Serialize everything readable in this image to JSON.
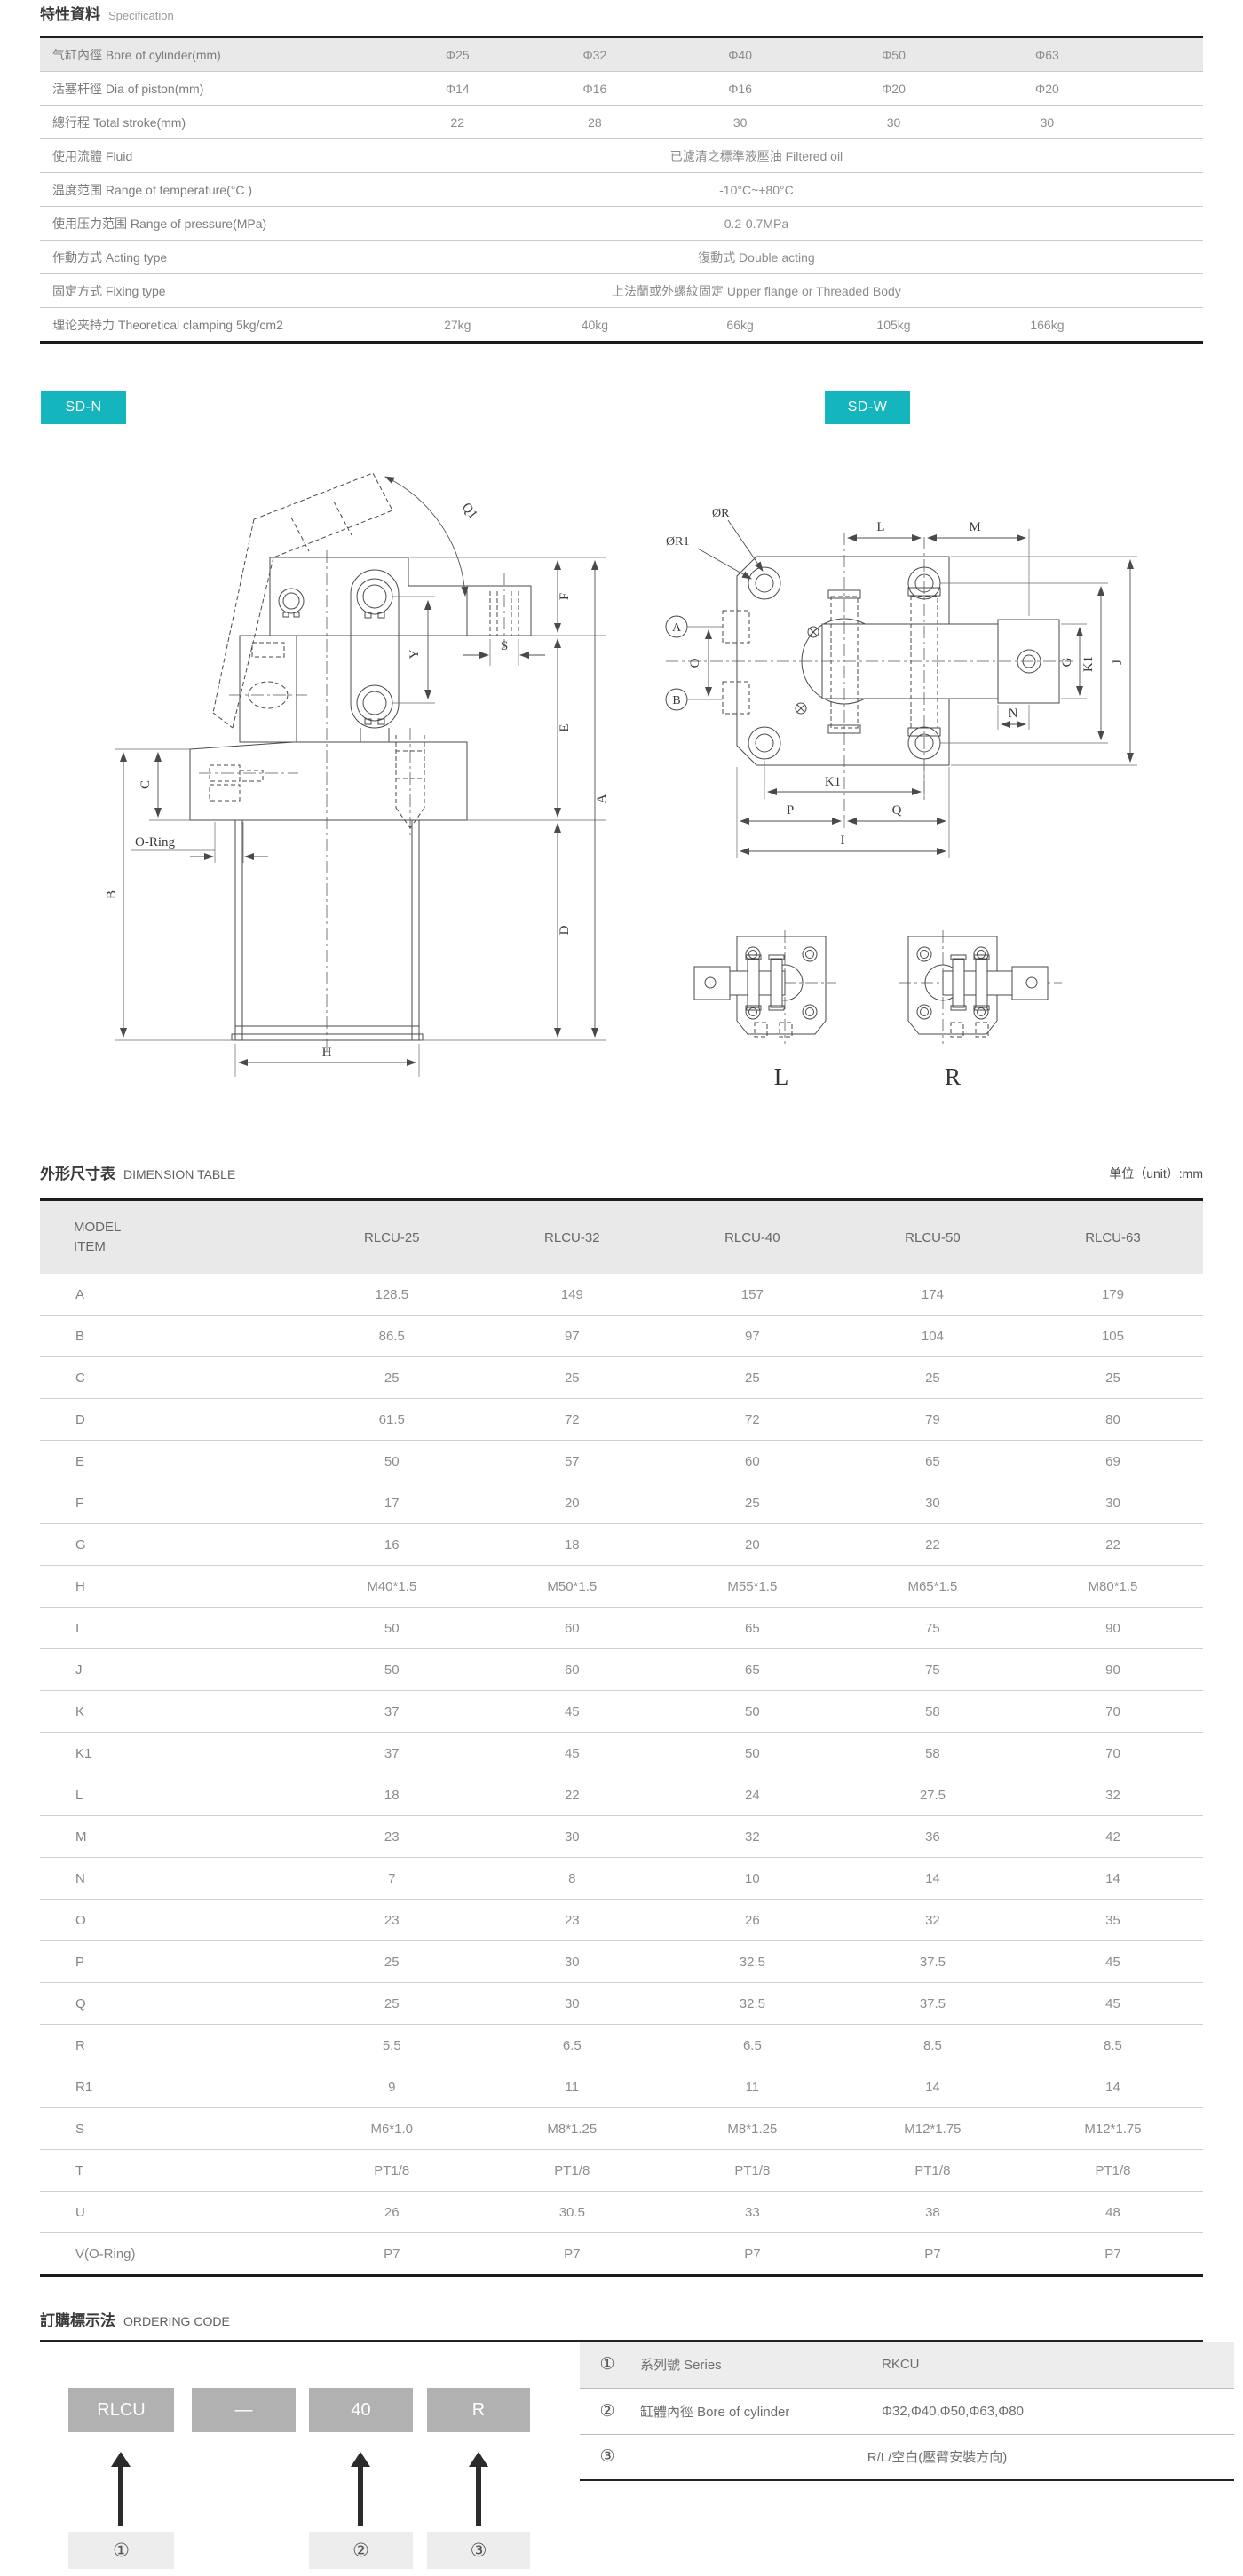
{
  "colors": {
    "accent_teal": "#14b5bc",
    "border_dark": "#1c1c1c",
    "header_bg": "#e9e9e9",
    "code_box_bg": "#b1b1b1",
    "callout_bg": "#ededed"
  },
  "spec_section": {
    "title_zh": "特性資料",
    "title_en": "Specification",
    "rows": [
      {
        "label": "气缸內徑  Bore of cylinder(mm)",
        "cells": [
          "Φ25",
          "Φ32",
          "Φ40",
          "Φ50",
          "Φ63"
        ],
        "shaded": true
      },
      {
        "label": "活塞杆徑  Dia of piston(mm)",
        "cells": [
          "Φ14",
          "Φ16",
          "Φ16",
          "Φ20",
          "Φ20"
        ]
      },
      {
        "label": "總行程  Total stroke(mm)",
        "cells": [
          "22",
          "28",
          "30",
          "30",
          "30"
        ]
      },
      {
        "label": "使用流體  Fluid",
        "span": "已濾清之標準液壓油 Filtered oil"
      },
      {
        "label": "温度范围  Range of temperature(°C )",
        "span": "-10°C~+80°C"
      },
      {
        "label": "使用压力范围  Range of pressure(MPa)",
        "span": "0.2-0.7MPa"
      },
      {
        "label": "作動方式  Acting type",
        "span": "復動式 Double acting"
      },
      {
        "label": "固定方式  Fixing type",
        "span": "上法蘭或外螺紋固定 Upper  flange or Threaded Body"
      },
      {
        "label": "理论夹持力  Theoretical clamping 5kg/cm2",
        "cells": [
          "27kg",
          "40kg",
          "66kg",
          "105kg",
          "166kg"
        ]
      }
    ]
  },
  "badges": {
    "left": "SD-N",
    "right": "SD-W"
  },
  "drawings": {
    "sd_n": {
      "q1": "Q1",
      "f": "F",
      "e": "E",
      "a": "A",
      "d": "D",
      "b": "B",
      "c": "C",
      "y": "Y",
      "s": "S",
      "h": "H",
      "o_ring": "O-Ring"
    },
    "sd_w": {
      "or": "ØR",
      "or1": "ØR1",
      "mark_a": "A",
      "mark_b": "B",
      "o": "O",
      "l": "L",
      "m": "M",
      "g": "G",
      "k1_right": "K1",
      "j": "J",
      "n": "N",
      "k1_bottom": "K1",
      "p": "P",
      "q": "Q",
      "i": "I"
    },
    "variants": {
      "left": "L",
      "right": "R"
    }
  },
  "dimension_section": {
    "title_zh": "外形尺寸表",
    "title_en": "DIMENSION TABLE",
    "unit_label": "单位（unit）:mm",
    "header": {
      "model_line1": "MODEL",
      "model_line2": "ITEM",
      "columns": [
        "RLCU-25",
        "RLCU-32",
        "RLCU-40",
        "RLCU-50",
        "RLCU-63"
      ]
    },
    "rows": [
      {
        "item": "A",
        "values": [
          "128.5",
          "149",
          "157",
          "174",
          "179"
        ]
      },
      {
        "item": "B",
        "values": [
          "86.5",
          "97",
          "97",
          "104",
          "105"
        ]
      },
      {
        "item": "C",
        "values": [
          "25",
          "25",
          "25",
          "25",
          "25"
        ]
      },
      {
        "item": "D",
        "values": [
          "61.5",
          "72",
          "72",
          "79",
          "80"
        ]
      },
      {
        "item": "E",
        "values": [
          "50",
          "57",
          "60",
          "65",
          "69"
        ]
      },
      {
        "item": "F",
        "values": [
          "17",
          "20",
          "25",
          "30",
          "30"
        ]
      },
      {
        "item": "G",
        "values": [
          "16",
          "18",
          "20",
          "22",
          "22"
        ]
      },
      {
        "item": "H",
        "values": [
          "M40*1.5",
          "M50*1.5",
          "M55*1.5",
          "M65*1.5",
          "M80*1.5"
        ]
      },
      {
        "item": "I",
        "values": [
          "50",
          "60",
          "65",
          "75",
          "90"
        ]
      },
      {
        "item": "J",
        "values": [
          "50",
          "60",
          "65",
          "75",
          "90"
        ]
      },
      {
        "item": "K",
        "values": [
          "37",
          "45",
          "50",
          "58",
          "70"
        ]
      },
      {
        "item": "K1",
        "values": [
          "37",
          "45",
          "50",
          "58",
          "70"
        ]
      },
      {
        "item": "L",
        "values": [
          "18",
          "22",
          "24",
          "27.5",
          "32"
        ]
      },
      {
        "item": "M",
        "values": [
          "23",
          "30",
          "32",
          "36",
          "42"
        ]
      },
      {
        "item": "N",
        "values": [
          "7",
          "8",
          "10",
          "14",
          "14"
        ]
      },
      {
        "item": "O",
        "values": [
          "23",
          "23",
          "26",
          "32",
          "35"
        ]
      },
      {
        "item": "P",
        "values": [
          "25",
          "30",
          "32.5",
          "37.5",
          "45"
        ]
      },
      {
        "item": "Q",
        "values": [
          "25",
          "30",
          "32.5",
          "37.5",
          "45"
        ]
      },
      {
        "item": "R",
        "values": [
          "5.5",
          "6.5",
          "6.5",
          "8.5",
          "8.5"
        ]
      },
      {
        "item": "R1",
        "values": [
          "9",
          "11",
          "11",
          "14",
          "14"
        ]
      },
      {
        "item": "S",
        "values": [
          "M6*1.0",
          "M8*1.25",
          "M8*1.25",
          "M12*1.75",
          "M12*1.75"
        ]
      },
      {
        "item": "T",
        "values": [
          "PT1/8",
          "PT1/8",
          "PT1/8",
          "PT1/8",
          "PT1/8"
        ]
      },
      {
        "item": "U",
        "values": [
          "26",
          "30.5",
          "33",
          "38",
          "48"
        ]
      },
      {
        "item": "V(O-Ring)",
        "values": [
          "P7",
          "P7",
          "P7",
          "P7",
          "P7"
        ]
      }
    ]
  },
  "ordering_section": {
    "title_zh": "訂購標示法",
    "title_en": "ORDERING CODE",
    "code_boxes": [
      "RLCU",
      "—",
      "40",
      "R"
    ],
    "callouts": [
      "①",
      "②",
      "③"
    ],
    "table": [
      {
        "num": "①",
        "label": "系列號 Series",
        "value": "RKCU",
        "shaded": true
      },
      {
        "num": "②",
        "label": "缸體內徑 Bore of cylinder",
        "value": "Φ32,Φ40,Φ50,Φ63,Φ80"
      },
      {
        "num": "③",
        "label": "",
        "value": "R/L/空白(壓臂安裝方向)",
        "center": true
      }
    ]
  }
}
